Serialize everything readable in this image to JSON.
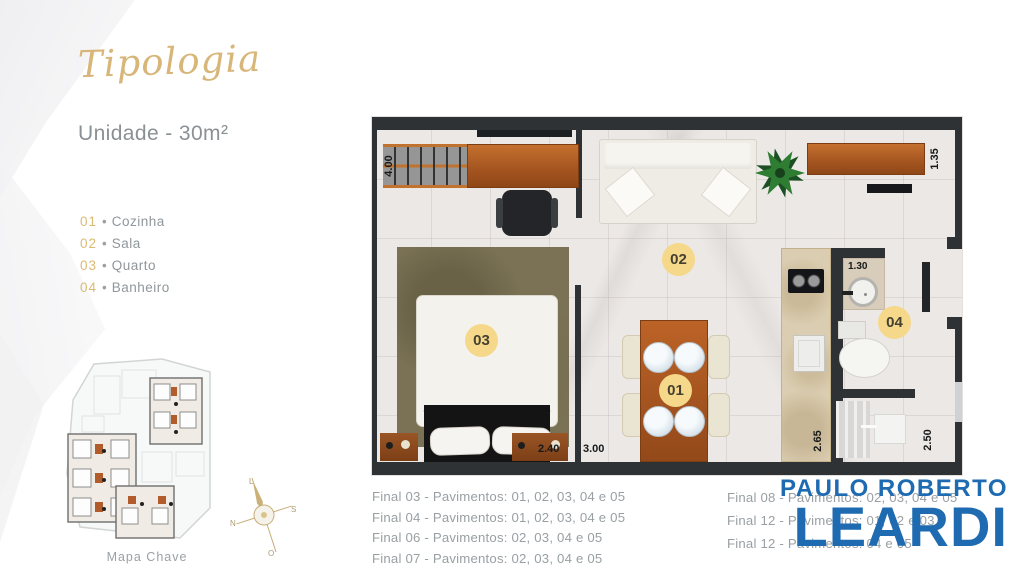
{
  "header": {
    "title": "Tipologia",
    "subtitle": "Unidade - 30m²"
  },
  "legend": {
    "separator": "•",
    "items": [
      {
        "num": "01",
        "label": "Cozinha"
      },
      {
        "num": "02",
        "label": "Sala"
      },
      {
        "num": "03",
        "label": "Quarto"
      },
      {
        "num": "04",
        "label": "Banheiro"
      }
    ]
  },
  "key_map": {
    "caption": "Mapa Chave"
  },
  "compass": {
    "top": "L",
    "right": "S",
    "bottom": "O",
    "left": "N"
  },
  "plan": {
    "room_labels": {
      "kitchen": "01",
      "living": "02",
      "bedroom": "03",
      "bathroom": "04"
    },
    "dimensions": {
      "rack": "4.00",
      "shelf": "1.35",
      "vanity": "1.30",
      "bed": "2.40",
      "living": "3.00",
      "counter": "2.65",
      "bathroom": "2.50"
    }
  },
  "finals": {
    "left": [
      "Final 03 - Pavimentos: 01, 02, 03, 04 e 05",
      "Final 04 - Pavimentos: 01, 02, 03, 04 e 05",
      "Final 06 - Pavimentos: 02, 03, 04 e 05",
      "Final 07 - Pavimentos: 02, 03, 04 e 05"
    ],
    "right": [
      "Final 08 - Pavimentos: 02, 03, 04 e 05",
      "Final 12 - Pavimentos: 01, 02 e 03",
      "Final 12 - Pavimentos: 04 e 05"
    ]
  },
  "watermark": {
    "line1": "PAULO ROBERTO",
    "line2": "LEARDI",
    "color": "#1e6bb1"
  },
  "colors": {
    "gold": "#d8b67a",
    "wall": "#2f3234",
    "label_circle": "#f5d88a"
  }
}
